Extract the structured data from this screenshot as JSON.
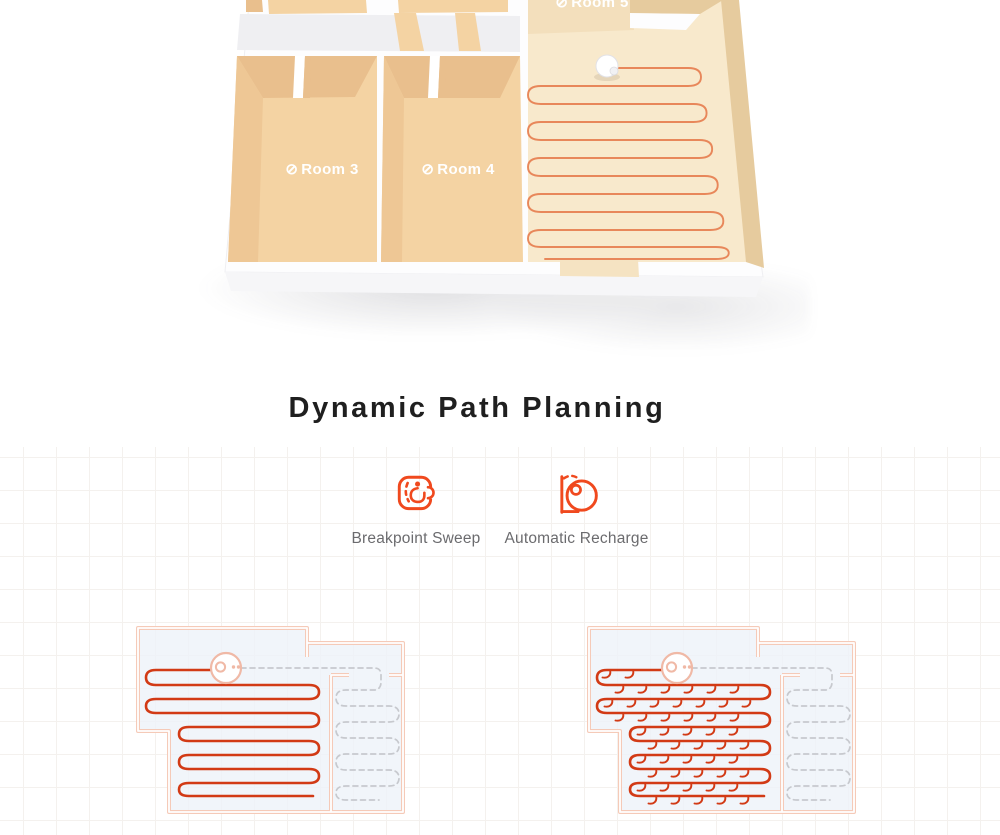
{
  "heading": {
    "title": "Dynamic Path Planning"
  },
  "floorplan": {
    "room_labels": [
      {
        "icon": "⊘",
        "text": "Room 5"
      },
      {
        "icon": "⊘",
        "text": "Room 3"
      },
      {
        "icon": "⊘",
        "text": "Room 4"
      }
    ]
  },
  "features": [
    {
      "icon": "breakpoint-sweep-icon",
      "label": "Breakpoint Sweep"
    },
    {
      "icon": "automatic-recharge-icon",
      "label": "Automatic Recharge"
    }
  ],
  "colors": {
    "accent": "#f0491e",
    "path-red": "#d23a15",
    "plan-path": "#e8875a",
    "wall-salmon": "#f5cab8",
    "dash-gray": "#c7c9ce",
    "room-fill": "#edf2f9",
    "robot-salmon": "#f0b9a6",
    "floor-tan": "#f4d3a3",
    "floor-tan-dark": "#e9bf8d",
    "floor-cream": "#f8e9cc",
    "wall-face": "#e6cb9e",
    "grid": "#f4f1ee",
    "heading": "#1f1f1f",
    "label-gray": "#6b6b6e"
  }
}
